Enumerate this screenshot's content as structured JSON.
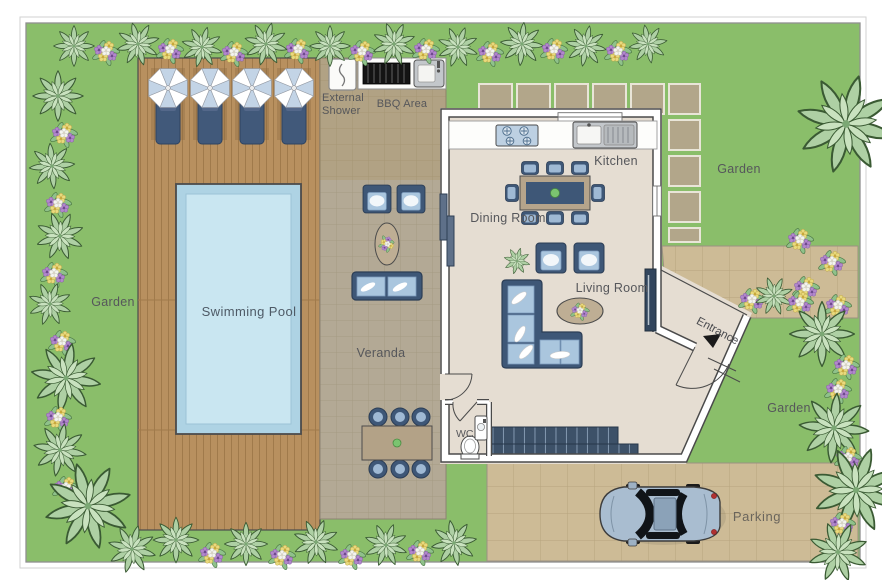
{
  "plan": {
    "type": "villa-floor-plan",
    "labels": {
      "swimming_pool": "Swimming Pool",
      "veranda": "Veranda",
      "external_shower_line1": "External",
      "external_shower_line2": "Shower",
      "bbq_area": "BBQ Area",
      "kitchen": "Kitchen",
      "dining_room": "Dining Room",
      "living_room": "Living Room",
      "entrance": "Entrance",
      "wc": "WC",
      "parking": "Parking",
      "garden_left": "Garden",
      "garden_top_right": "Garden",
      "garden_bottom_right": "Garden"
    },
    "icons": [
      "umbrella-icon",
      "sun-lounger-icon",
      "shower-icon",
      "bbq-grill-icon",
      "outdoor-sink-icon",
      "gas-hob-icon",
      "kitchen-sink-icon",
      "dining-table-icon",
      "chair-icon",
      "armchair-icon",
      "sofa-icon",
      "corner-sofa-icon",
      "coffee-table-icon",
      "flower-table-icon",
      "tv-icon",
      "toilet-icon",
      "washbasin-icon",
      "stairs-icon",
      "door-swing-icon",
      "entrance-arrow-icon",
      "car-icon",
      "plant-bush-icon",
      "flower-cluster-icon",
      "stepping-stone-icon"
    ],
    "colors": {
      "grass": "#8abe6a",
      "deck_wood": "#b8905f",
      "veranda_tile": "#b3a995",
      "pavement": "#cdbb96",
      "pool_water": "#aed3e4",
      "pool_water_light": "#c9e6f1",
      "house_floor": "#e5ddd2",
      "wall": "#ffffff",
      "wall_outline": "#4a4a4a",
      "furniture_frame": "#3e5777",
      "furniture_cushion": "#aac6de",
      "stairs": "#3d5168",
      "car_body": "#a9bdd0",
      "plant_leaf": "#aed0a4",
      "flower_purple": "#b287cc",
      "flower_yellow": "#e9da7d",
      "label_text": "#56575b"
    }
  }
}
